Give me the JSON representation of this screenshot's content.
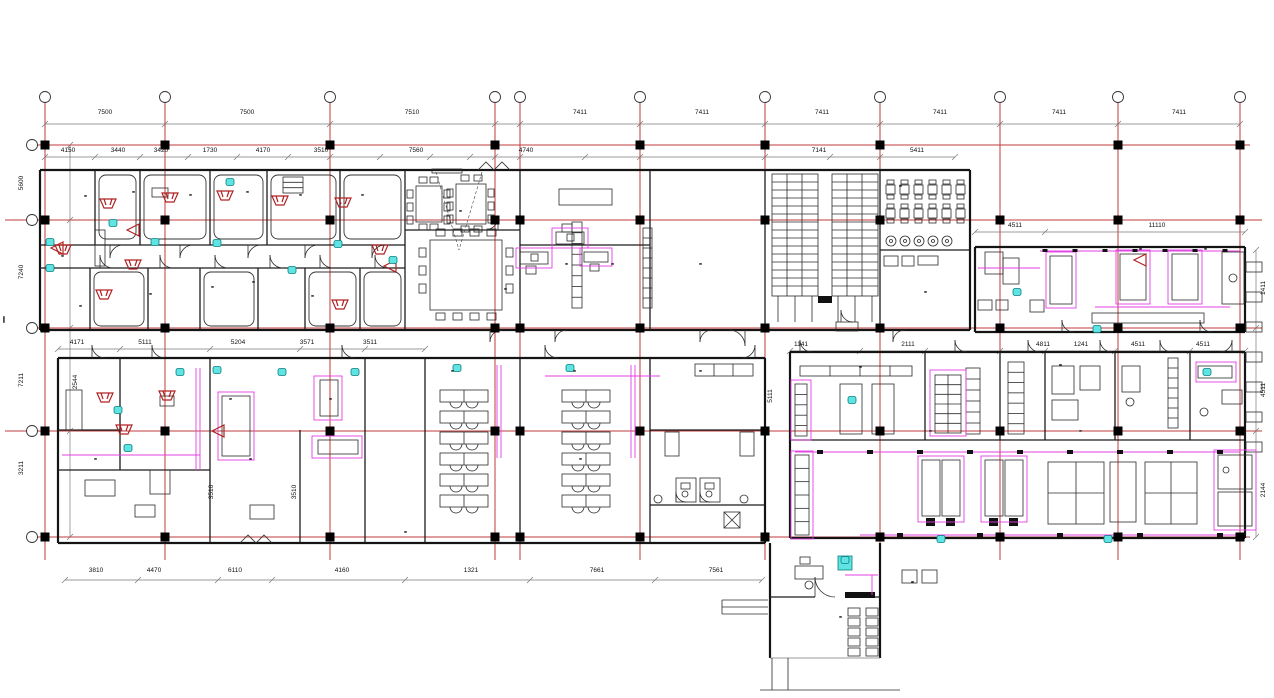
{
  "drawing": {
    "kind": "architectural floor plan (CAD)",
    "blob_text": "▪▪▪",
    "vertical_edge_text": "▪▪▪▪▪▪▪▪"
  },
  "colors": {
    "grid_red": "#c23b3b",
    "wall_black": "#141414",
    "annotation_magenta": "#e33fe3",
    "marker_cyan": "#5fe3e3",
    "symbol_dark_red": "#b22222",
    "dimension_gray": "#7a7a7a"
  },
  "dim_labels": [
    {
      "t": "7500",
      "x": 105,
      "y": 113
    },
    {
      "t": "7500",
      "x": 247,
      "y": 113
    },
    {
      "t": "7510",
      "x": 412,
      "y": 113
    },
    {
      "t": "7411",
      "x": 580,
      "y": 113
    },
    {
      "t": "7411",
      "x": 702,
      "y": 113
    },
    {
      "t": "7411",
      "x": 822,
      "y": 113
    },
    {
      "t": "7411",
      "x": 940,
      "y": 113
    },
    {
      "t": "7411",
      "x": 1059,
      "y": 113
    },
    {
      "t": "7411",
      "x": 1179,
      "y": 113
    },
    {
      "t": "4150",
      "x": 68,
      "y": 151
    },
    {
      "t": "3440",
      "x": 118,
      "y": 151
    },
    {
      "t": "3420",
      "x": 161,
      "y": 151
    },
    {
      "t": "1730",
      "x": 210,
      "y": 151
    },
    {
      "t": "4170",
      "x": 263,
      "y": 151
    },
    {
      "t": "3510",
      "x": 321,
      "y": 151
    },
    {
      "t": "7560",
      "x": 416,
      "y": 151
    },
    {
      "t": "4740",
      "x": 526,
      "y": 151
    },
    {
      "t": "7141",
      "x": 819,
      "y": 151
    },
    {
      "t": "5411",
      "x": 917,
      "y": 151
    },
    {
      "t": "4511",
      "x": 1015,
      "y": 226
    },
    {
      "t": "11110",
      "x": 1157,
      "y": 226
    },
    {
      "t": "4171",
      "x": 77,
      "y": 343
    },
    {
      "t": "5111",
      "x": 145,
      "y": 343
    },
    {
      "t": "5204",
      "x": 238,
      "y": 343
    },
    {
      "t": "3571",
      "x": 307,
      "y": 343
    },
    {
      "t": "3511",
      "x": 370,
      "y": 343
    },
    {
      "t": "1141",
      "x": 801,
      "y": 345
    },
    {
      "t": "2111",
      "x": 908,
      "y": 345
    },
    {
      "t": "4811",
      "x": 1043,
      "y": 345
    },
    {
      "t": "1241",
      "x": 1081,
      "y": 345
    },
    {
      "t": "4511",
      "x": 1138,
      "y": 345
    },
    {
      "t": "4511",
      "x": 1203,
      "y": 345
    },
    {
      "t": "3810",
      "x": 96,
      "y": 571
    },
    {
      "t": "4470",
      "x": 154,
      "y": 571
    },
    {
      "t": "6110",
      "x": 235,
      "y": 571
    },
    {
      "t": "4160",
      "x": 342,
      "y": 571
    },
    {
      "t": "1321",
      "x": 471,
      "y": 571
    },
    {
      "t": "7661",
      "x": 597,
      "y": 571
    },
    {
      "t": "7561",
      "x": 716,
      "y": 571
    },
    {
      "t": "5600",
      "x": 22,
      "y": 183,
      "rot": true
    },
    {
      "t": "7240",
      "x": 22,
      "y": 272,
      "rot": true
    },
    {
      "t": "7211",
      "x": 22,
      "y": 380,
      "rot": true
    },
    {
      "t": "3211",
      "x": 22,
      "y": 468,
      "rot": true
    },
    {
      "t": "1411",
      "x": 1264,
      "y": 288,
      "rot": true
    },
    {
      "t": "4511",
      "x": 1264,
      "y": 390,
      "rot": true
    },
    {
      "t": "2144",
      "x": 1264,
      "y": 490,
      "rot": true
    },
    {
      "t": "2544",
      "x": 76,
      "y": 382,
      "rot": true
    },
    {
      "t": "3510",
      "x": 212,
      "y": 492,
      "rot": true
    },
    {
      "t": "3510",
      "x": 295,
      "y": 492,
      "rot": true
    },
    {
      "t": "5111",
      "x": 771,
      "y": 396,
      "rot": true
    }
  ],
  "room_label_blobs": [
    [
      85,
      197
    ],
    [
      133,
      193
    ],
    [
      190,
      196
    ],
    [
      247,
      193
    ],
    [
      300,
      196
    ],
    [
      362,
      196
    ],
    [
      62,
      257
    ],
    [
      80,
      307
    ],
    [
      150,
      295
    ],
    [
      212,
      288
    ],
    [
      253,
      283
    ],
    [
      312,
      297
    ],
    [
      460,
      212
    ],
    [
      566,
      265
    ],
    [
      612,
      265
    ],
    [
      700,
      265
    ],
    [
      828,
      302
    ],
    [
      900,
      187
    ],
    [
      925,
      293
    ],
    [
      1140,
      250
    ],
    [
      1205,
      250
    ],
    [
      505,
      290
    ],
    [
      452,
      372
    ],
    [
      574,
      372
    ],
    [
      700,
      372
    ],
    [
      860,
      368
    ],
    [
      1060,
      366
    ],
    [
      230,
      400
    ],
    [
      330,
      400
    ],
    [
      95,
      460
    ],
    [
      250,
      460
    ],
    [
      580,
      460
    ],
    [
      930,
      432
    ],
    [
      1080,
      432
    ],
    [
      405,
      533
    ],
    [
      840,
      618
    ],
    [
      912,
      583
    ]
  ]
}
